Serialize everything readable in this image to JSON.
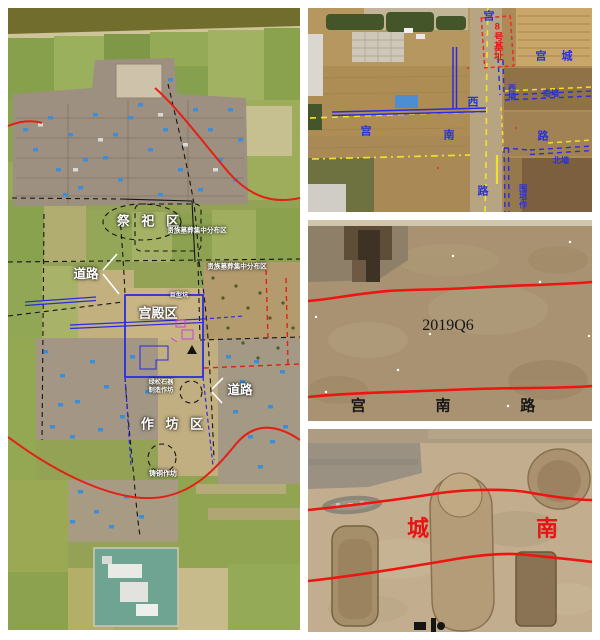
{
  "figure_type": "archaeological site aerial figure, four photo panels",
  "colors": {
    "annotation_red": "#e81414",
    "annotation_blue": "#2733d6",
    "annotation_yellow": "#f2df2c",
    "label_white": "#ffffff",
    "label_black": "#161616"
  },
  "panels": {
    "site_map": {
      "description": "satellite overview with zoned annotations",
      "labels": {
        "sacrificial_area": "祭 祀 区",
        "noble_tombs_a": "贵族墓葬集中分布区",
        "noble_tombs_b": "贵族墓葬集中分布区",
        "road_nw": "道路",
        "palace_area": "宫殿区",
        "giant_pit": "巨型坑",
        "road_se": "道路",
        "workshop_area": "作 坊 区",
        "turquoise_l1": "绿松石器",
        "turquoise_l2": "制造作坊",
        "bronze_workshop": "铸铜作坊"
      }
    },
    "excavation_plan": {
      "description": "aerial photo of excavation with road and wall lines",
      "labels": {
        "gong_west_1": "宫",
        "gong_west_2": "西",
        "gong_west_3": "路",
        "gong_south_1": "宫",
        "gong_south_2": "南",
        "gong_south_3": "路",
        "foundation_no8": "8号基址",
        "palace_city": "宫 城",
        "west_wall": "西墙",
        "south_wall": "南墙",
        "north_wall": "北墙",
        "enclosure_workshop": "围垣作"
      }
    },
    "trench_q6": {
      "description": "excavation trench photo of palace-south road",
      "labels": {
        "unit_number": "2019Q6",
        "road_name": "宫 南 路"
      }
    },
    "trench_city_south": {
      "description": "excavation trench photo with pits",
      "labels": {
        "char_cheng": "城",
        "char_nan": "南"
      }
    }
  }
}
